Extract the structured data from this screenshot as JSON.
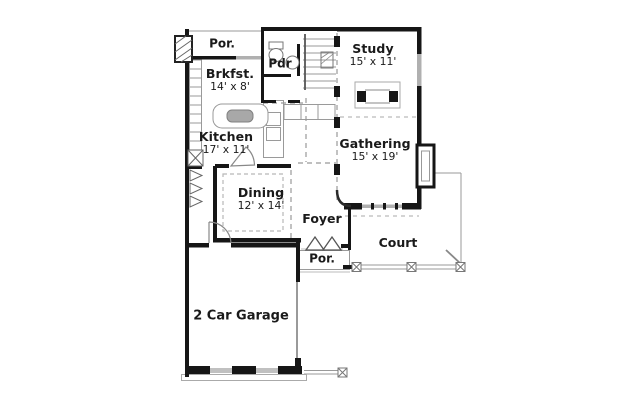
{
  "plan": {
    "title": "First floor plan",
    "rooms": {
      "porch_top": {
        "label": "Por."
      },
      "breakfast": {
        "name": "Brkfst.",
        "dims": "14' x 8'"
      },
      "powder": {
        "label": "Pdr"
      },
      "study": {
        "name": "Study",
        "dims": "15' x 11'"
      },
      "gathering": {
        "name": "Gathering",
        "dims": "15' x 19'"
      },
      "kitchen": {
        "name": "Kitchen",
        "dims": "17' x 11'"
      },
      "dining": {
        "name": "Dining",
        "dims": "12' x 14'"
      },
      "foyer": {
        "label": "Foyer"
      },
      "front_porch": {
        "label": "Por."
      },
      "court": {
        "label": "Court"
      },
      "garage": {
        "label": "2 Car Garage"
      }
    },
    "colors": {
      "wall": "#161616",
      "thin_line": "#9a9a9a",
      "window": "#b0b0b0",
      "text": "#1a1a1a",
      "background": "#ffffff"
    }
  }
}
